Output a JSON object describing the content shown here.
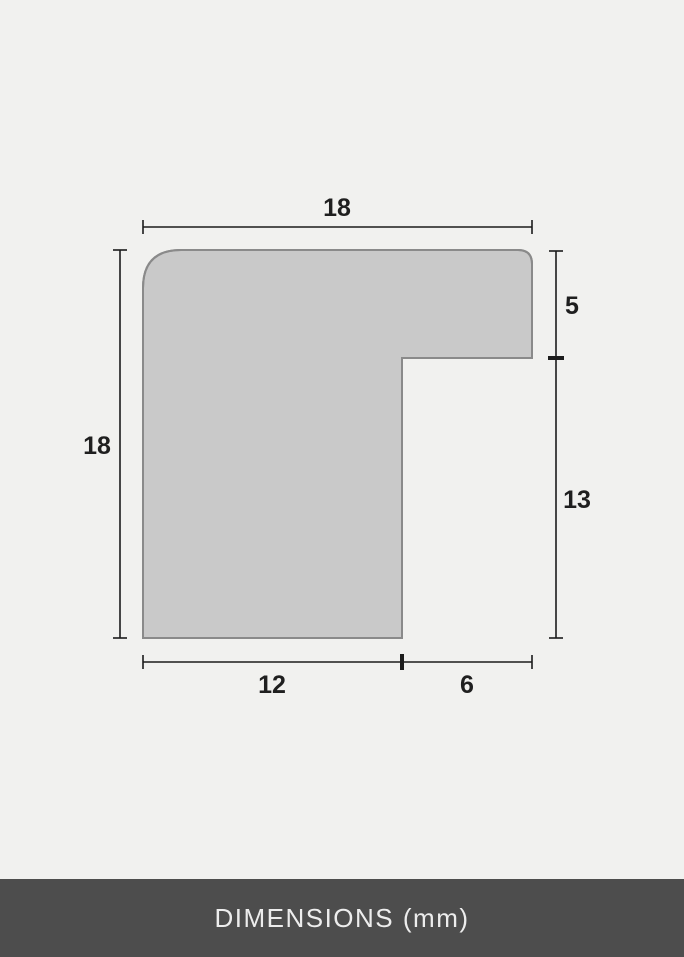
{
  "diagram": {
    "name": "frame-profile-cross-section",
    "unit": "mm",
    "dimensions": {
      "total_width": "18",
      "total_height": "18",
      "lip_height": "5",
      "rabbet_depth": "13",
      "face_width": "12",
      "inner_width": "6"
    },
    "colors": {
      "background": "#f1f1ef",
      "shape_fill": "#c9c9c9",
      "shape_outline": "#8a8a8a",
      "line_color": "#1c1c1c",
      "label_color": "#1f1f1f"
    }
  },
  "footer": {
    "label": "DIMENSIONS (mm)",
    "background": "#4d4d4d",
    "text_color": "#ededed"
  }
}
